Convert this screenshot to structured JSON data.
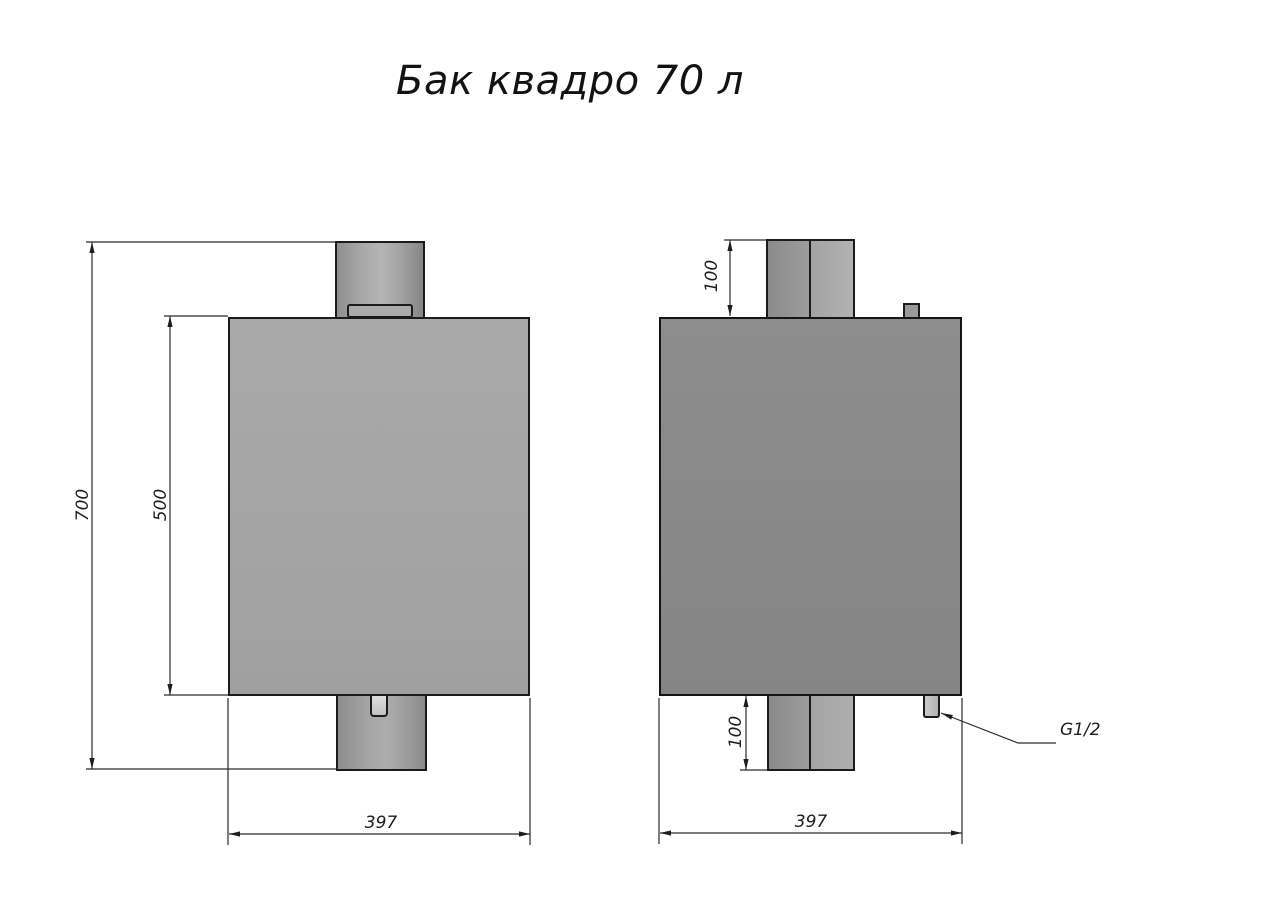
{
  "title": "Бак квадро 70 л",
  "drawing": {
    "front_view": {
      "dim_total_height": "700",
      "dim_body_height": "500",
      "dim_width": "397"
    },
    "side_view": {
      "dim_top_pipe_offset": "100",
      "dim_bottom_pipe_offset": "100",
      "dim_width": "397",
      "fitting_thread_label": "G1/2"
    },
    "colors": {
      "outline": "#1b1b1b",
      "front_body_fill": "#a6a6a6",
      "side_body_fill": "#8a8a8a",
      "pipe_highlight": "#b2b2b2",
      "fitting_light": "#cbcbcb",
      "background": "#ffffff"
    }
  }
}
